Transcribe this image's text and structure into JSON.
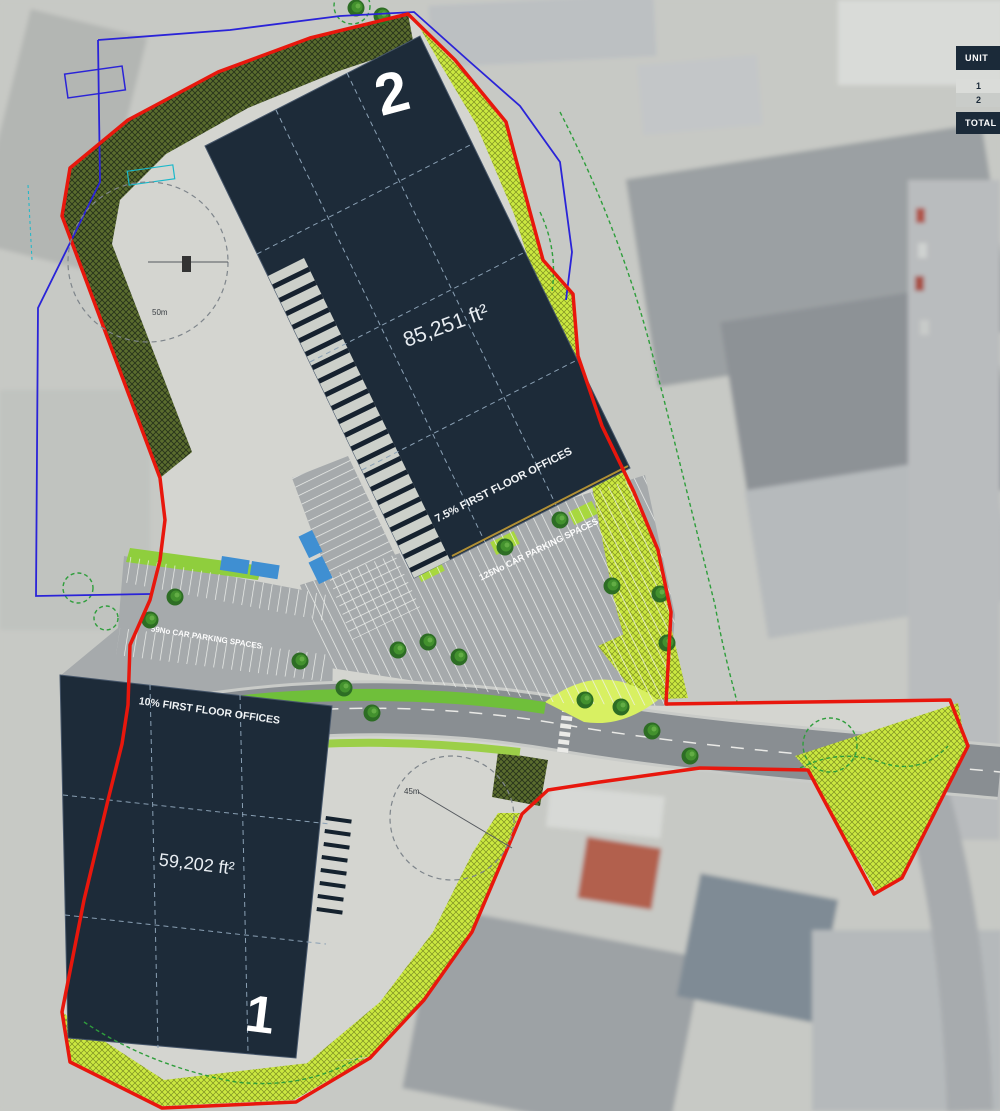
{
  "legend": {
    "header": "UNIT",
    "row1": "1",
    "row2": "2",
    "footer": "TOTAL"
  },
  "unit2": {
    "number": "2",
    "area": "85,251 ft²",
    "offices": "7.5% FIRST FLOOR OFFICES"
  },
  "unit1": {
    "number": "1",
    "area": "59,202 ft²",
    "offices": "10% FIRST FLOOR OFFICES"
  },
  "parking": {
    "north": "125No CAR PARKING SPACES",
    "west": "59No CAR PARKING SPACES"
  },
  "turning_circles": {
    "north": "50m",
    "south": "45m"
  },
  "colors": {
    "building_roof": "#1d2b39",
    "site_boundary_red": "#e8170d",
    "ownership_boundary_blue": "#2a23d8",
    "vegetation_green": "#2f9e3c",
    "landscape_lime": "#cbe840",
    "landscape_olive": "#5a6c2e",
    "road_gray": "#898e92",
    "parking_tarmac": "#a6aaac",
    "yard_concrete": "#d4d5d0",
    "accessible_bay_blue": "#3f8fd2"
  }
}
